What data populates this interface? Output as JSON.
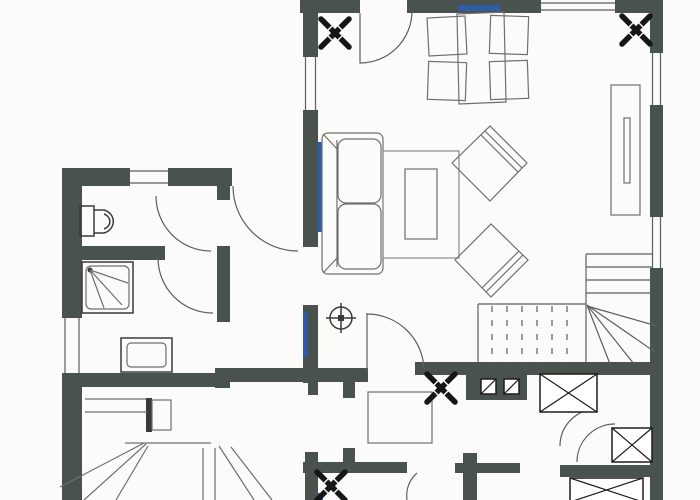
{
  "plan": {
    "kind": "scanned architectural floor plan, furnished, no text labels",
    "colors": {
      "background": "#fbfbf9",
      "wall": "#4a524e",
      "line": "#5e5e5e",
      "furn": "#6f6f6f",
      "fixture": "#3a3a3a",
      "box": "#1c1c1c",
      "blue": "#2e5ca8",
      "black": "#161616"
    },
    "rooms": [
      {
        "name": "living-room",
        "fixtures": [
          "balcony-door-arc",
          "window-blue-top",
          "dining-table",
          "dining-chair x4",
          "sofa",
          "radiator-blue",
          "rug",
          "coffee-table",
          "armchair x2",
          "sideboard",
          "ceiling-light-symbol",
          "cross-symbol x2",
          "staircase-with-winders",
          "door-arc-to-kitchen"
        ]
      },
      {
        "name": "wc-room",
        "fixtures": [
          "toilet",
          "window-top",
          "door-arc"
        ]
      },
      {
        "name": "bathroom",
        "fixtures": [
          "shower-with-spray-lines",
          "bathtub",
          "window-left",
          "door-arc"
        ]
      },
      {
        "name": "hallway",
        "fixtures": [
          "entrance-door-arc",
          "radiator-blue"
        ]
      },
      {
        "name": "kitchen",
        "fixtures": [
          "kitchen-table",
          "cooktop-counter-2-burners",
          "cross-symbol",
          "tall-cabinet-x-box",
          "door-arcs",
          "small-x-box"
        ]
      },
      {
        "name": "bedroom",
        "fixtures": [
          "bed-fan-lines",
          "nightstand-with-radiator-bar",
          "cross-symbol",
          "window-left",
          "blue-tick"
        ]
      },
      {
        "name": "bottom-right-room",
        "fixtures": [
          "x-box-cabinet"
        ]
      }
    ]
  }
}
